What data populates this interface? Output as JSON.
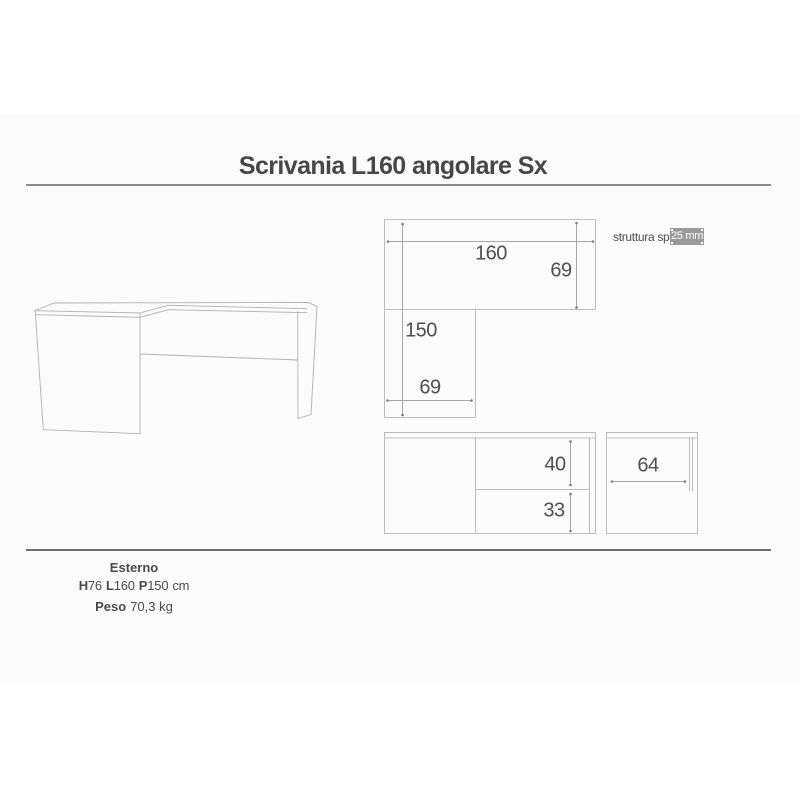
{
  "title": "Scrivania L160 angolare Sx",
  "structure_note": {
    "label": "struttura sp.",
    "value": "25 mm"
  },
  "dimensions_cm": {
    "plan_width": "160",
    "plan_depth": "69",
    "plan_return_length": "150",
    "plan_return_width": "69",
    "front_upper": "40",
    "front_lower": "33",
    "side_depth": "64"
  },
  "specs": {
    "heading": "Esterno",
    "height_label": "H",
    "height_value": "76",
    "length_label": "L",
    "length_value": "160",
    "depth_label": "P",
    "depth_value": "150",
    "size_unit": "cm",
    "weight_label": "Peso",
    "weight_value": "70,3 kg"
  },
  "colors": {
    "value_box_bg": "#9b9b9b",
    "value_box_text": "#ffffff",
    "drawing_line": "#b0b0b0",
    "dimension_text": "#4f4f4f",
    "title_text": "#474747",
    "separator": "#8a8a8a"
  }
}
